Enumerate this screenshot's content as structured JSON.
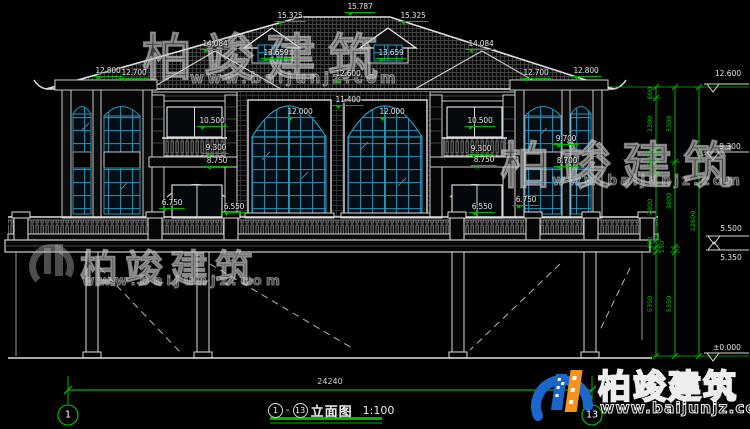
{
  "drawing_meta": {
    "sheet_title": {
      "axis_from": "1",
      "separator": "-",
      "axis_to": "13",
      "name": "立面图",
      "scale": "1:100"
    },
    "axis_bubbles": {
      "left": "1",
      "right": "13"
    },
    "overall_width": "24240"
  },
  "elevation_labels": [
    "15.787",
    "15.325",
    "15.325",
    "14.084",
    "14.084",
    "13.659",
    "13.659",
    "12.800",
    "12.700",
    "12.600",
    "12.700",
    "12.800",
    "11.400",
    "12.000",
    "12.000",
    "10.500",
    "10.500",
    "9.300",
    "9.300",
    "8.750",
    "8.750",
    "9.700",
    "8.700",
    "6.750",
    "6.550",
    "6.550",
    "6.750"
  ],
  "right_level_labels": [
    "12.600",
    "9.300",
    "5.500",
    "5.350",
    "±0.000"
  ],
  "dim_chain_labels": [
    "600",
    "2300",
    "400",
    "600",
    "2800",
    "400",
    "150",
    "5350",
    "3300",
    "3800",
    "5350",
    "12600"
  ],
  "watermark": {
    "company": "柏竣建筑",
    "url": "www.baijunjz.com"
  },
  "colors": {
    "dimension_green": "#00b400",
    "window_frame_teal": "#2d93b8",
    "logo_blue": "#1b66c9",
    "logo_orange": "#f6921e",
    "background": "#000000"
  }
}
